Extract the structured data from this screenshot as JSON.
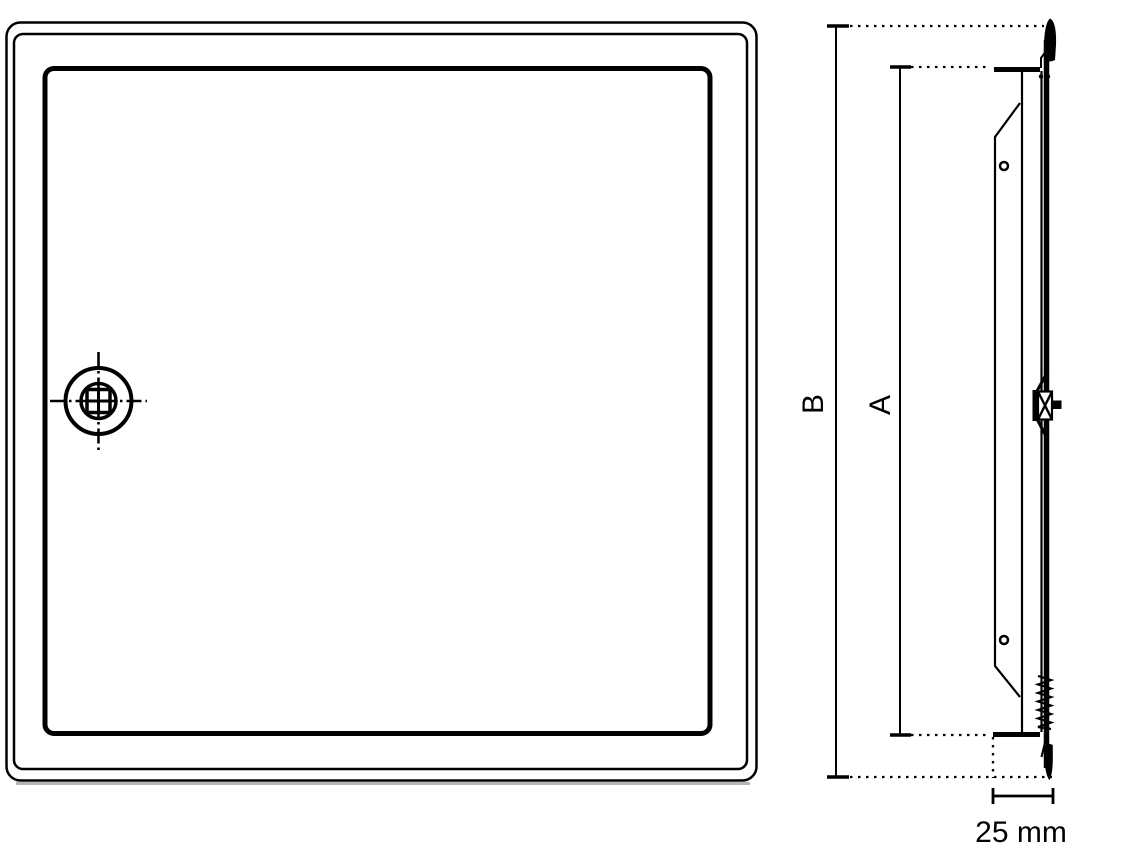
{
  "colors": {
    "line": "#000000",
    "background": "#ffffff",
    "shadow": "#9e9e9e"
  },
  "dimensions": {
    "b_label": "B",
    "a_label": "A",
    "depth_label": "25 mm"
  },
  "icons": {
    "front_lock": "square-drive-cam-lock-icon",
    "side_spring": "spring-coil-icon",
    "side_latch": "latch-cam-icon",
    "side_screw_holes": "screw-hole-icon"
  }
}
